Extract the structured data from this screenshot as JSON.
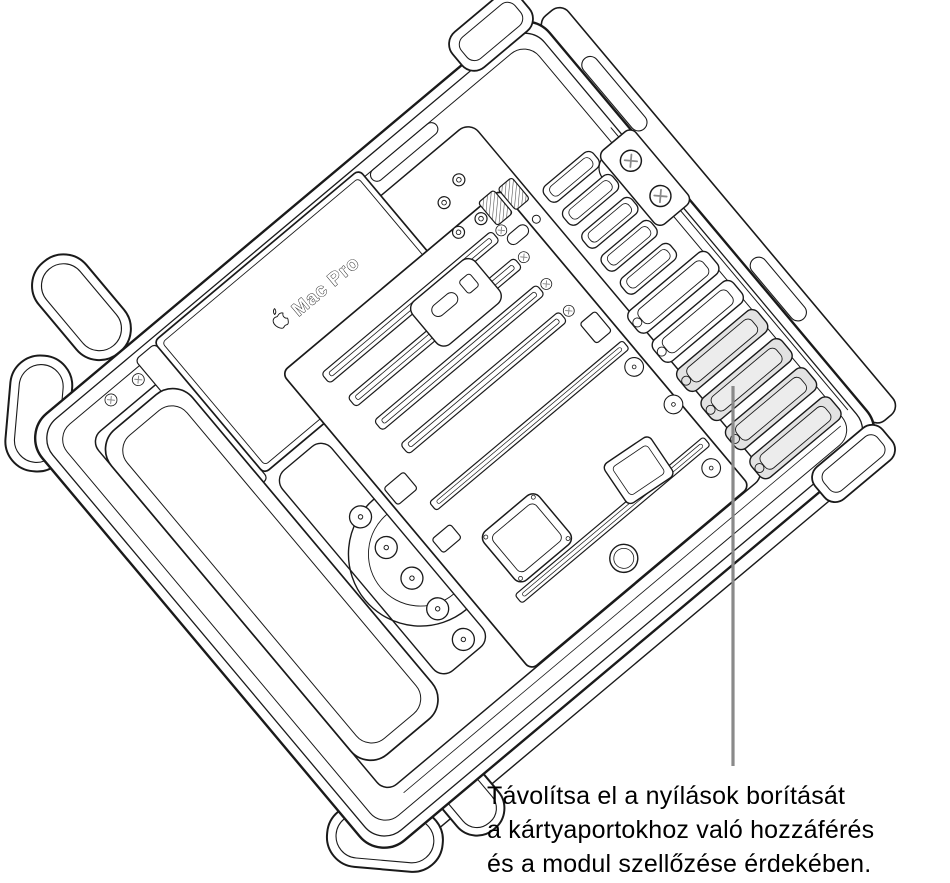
{
  "device_label": {
    "text": "Mac Pro",
    "icon": "apple-logo"
  },
  "callout": {
    "lines": [
      "Távolítsa el a nyílások borítását",
      "a kártyaportokhoz való hozzáférés",
      "és a modul szellőzése érdekében."
    ],
    "target_part": "slot-covers",
    "highlighted_slot_cover_count": 4,
    "pointer_line_color": "#8a8a8a",
    "highlight_fill": "#e2e2e2"
  },
  "style_colors": {
    "outline": "#1a1a1a",
    "background": "#ffffff",
    "caption_text": "#000000"
  }
}
